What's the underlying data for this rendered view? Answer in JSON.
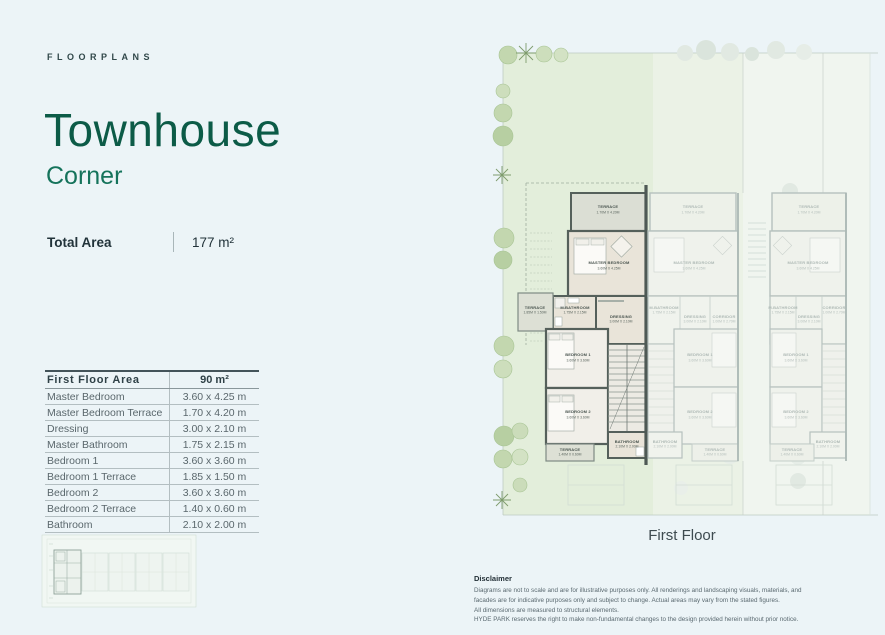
{
  "page": {
    "eyebrow": "FLOORPLANS",
    "title": "Townhouse",
    "subtitle": "Corner"
  },
  "total_area": {
    "label": "Total Area",
    "value": "177 m²"
  },
  "table": {
    "header": {
      "label": "First Floor Area",
      "value": "90 m²"
    },
    "rows": [
      [
        "Master Bedroom",
        "3.60 x 4.25 m"
      ],
      [
        "Master Bedroom Terrace",
        "1.70 x 4.20 m"
      ],
      [
        "Dressing",
        "3.00 x 2.10 m"
      ],
      [
        "Master Bathroom",
        "1.75 x 2.15 m"
      ],
      [
        "Bedroom 1",
        "3.60 x 3.60 m"
      ],
      [
        "Bedroom 1 Terrace",
        "1.85 x 1.50 m"
      ],
      [
        "Bedroom 2",
        "3.60 x 3.60 m"
      ],
      [
        "Bedroom 2 Terrace",
        "1.40 x 0.60 m"
      ],
      [
        "Bathroom",
        "2.10 x 2.00 m"
      ]
    ]
  },
  "floorplan": {
    "caption": "First Floor",
    "units": {
      "corner": {
        "terrace_top": {
          "name": "TERRACE",
          "dims": "1.70M X 4.20M"
        },
        "master_bedroom": {
          "name": "MASTER BEDROOM",
          "dims": "3.60M X 4.25M"
        },
        "master_bathroom": {
          "name": "M.BATHROOM",
          "dims": "1.75M X 2.15M"
        },
        "terrace_side": {
          "name": "TERRACE",
          "dims": "1.85M X 1.50M"
        },
        "dressing": {
          "name": "DRESSING",
          "dims": "3.00M X 2.10M"
        },
        "bedroom1": {
          "name": "BEDROOM 1",
          "dims": "3.60M X 3.60M"
        },
        "bedroom2": {
          "name": "BEDROOM 2",
          "dims": "3.60M X 3.60M"
        },
        "bathroom": {
          "name": "BATHROOM",
          "dims": "2.10M X 2.00M"
        },
        "terrace_bottom": {
          "name": "TERRACE",
          "dims": "1.40M X 0.60M"
        }
      },
      "middle": {
        "terrace_top": {
          "name": "TERRACE",
          "dims": "1.70M X 4.20M"
        },
        "master_bedroom": {
          "name": "MASTER BEDROOM",
          "dims": "3.60M X 4.25M"
        },
        "master_bathroom": {
          "name": "M.BATHROOM",
          "dims": "1.75M X 2.15M"
        },
        "dressing": {
          "name": "DRESSING",
          "dims": "3.00M X 2.10M"
        },
        "corridor": {
          "name": "CORRIDOR",
          "dims": "1.00M X 2.70M"
        },
        "bedroom1": {
          "name": "BEDROOM 1",
          "dims": "3.60M X 3.60M"
        },
        "bedroom2": {
          "name": "BEDROOM 2",
          "dims": "3.60M X 3.60M"
        },
        "bathroom": {
          "name": "BATHROOM",
          "dims": "2.10M X 2.00M"
        },
        "terrace_bottom": {
          "name": "TERRACE",
          "dims": "1.40M X 0.60M"
        }
      },
      "right": {
        "terrace_top": {
          "name": "TERRACE",
          "dims": "1.70M X 4.20M"
        },
        "master_bedroom": {
          "name": "MASTER BEDROOM",
          "dims": "3.60M X 4.25M"
        },
        "master_bathroom": {
          "name": "M.BATHROOM",
          "dims": "1.75M X 2.15M"
        },
        "dressing": {
          "name": "DRESSING",
          "dims": "3.00M X 2.10M"
        },
        "corridor": {
          "name": "CORRIDOR",
          "dims": "1.00M X 2.70M"
        },
        "bedroom1": {
          "name": "BEDROOM 1",
          "dims": "3.60M X 3.60M"
        },
        "bedroom2": {
          "name": "BEDROOM 2",
          "dims": "3.60M X 3.60M"
        },
        "bathroom": {
          "name": "BATHROOM",
          "dims": "2.10M X 2.00M"
        },
        "terrace_bottom": {
          "name": "TERRACE",
          "dims": "1.40M X 0.60M"
        }
      }
    }
  },
  "disclaimer": {
    "title": "Disclaimer",
    "lines": [
      "Diagrams are not to scale and are for illustrative purposes only. All renderings and landscaping visuals, materials, and",
      "facades are for indicative purposes only and subject to change. Actual areas may vary from the stated figures.",
      "All dimensions are measured to structural elements.",
      "HYDE PARK reserves the right to make non-fundamental changes to the design provided herein without prior notice."
    ]
  },
  "colors": {
    "background": "#ECF4F7",
    "title_green": "#0C5B47",
    "subtitle_green": "#15735B",
    "garden_green": "#E3EEDB",
    "wall_dark": "#4E5955",
    "floor_beige": "#E9E4D9"
  }
}
